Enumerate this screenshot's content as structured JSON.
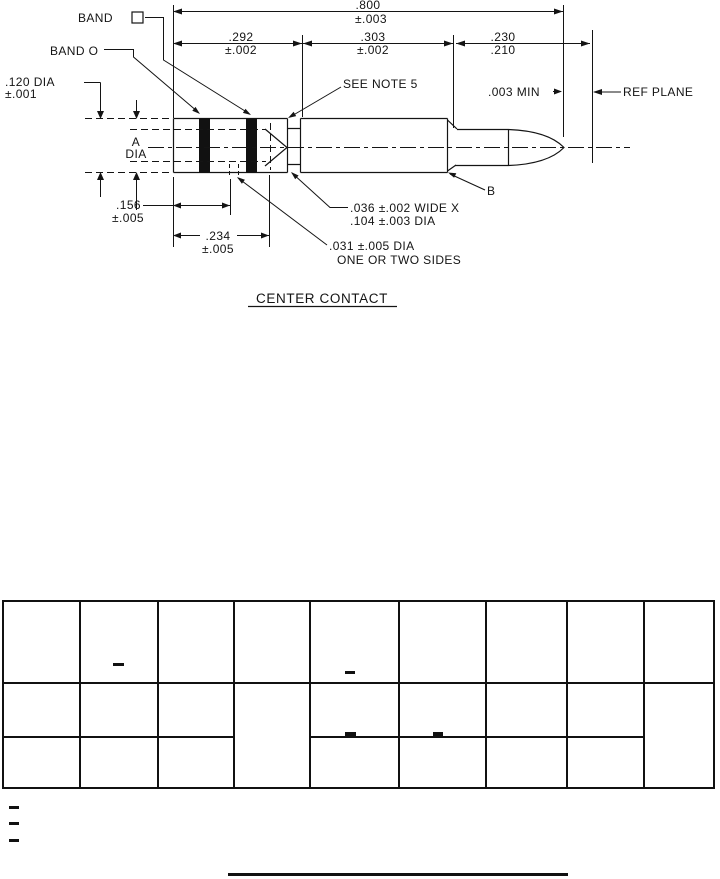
{
  "drawing": {
    "title": "CENTER CONTACT",
    "callouts": {
      "band1_label": "BAND",
      "band1_symbol": "square",
      "band2_label": "BAND O",
      "dia120_value": ".120 DIA",
      "dia120_tol": "±.001",
      "a_dia_line1": "A",
      "a_dia_line2": "DIA",
      "see_note": "SEE NOTE 5",
      "min_gap": ".003 MIN",
      "ref_plane": "REF PLANE",
      "point_b": "B",
      "groove_line1": ".036 ±.002 WIDE  X",
      "groove_line2": ".104 ±.003 DIA",
      "hole_line1": ".031 ±.005 DIA",
      "hole_line2": "ONE OR TWO SIDES"
    },
    "dimensions": {
      "overall": {
        "value": ".800",
        "tol": "±.003"
      },
      "seg1": {
        "value": ".292",
        "tol": "±.002"
      },
      "seg2": {
        "value": ".303",
        "tol": "±.002"
      },
      "seg3": {
        "max": ".230",
        "min": ".210"
      },
      "len156": {
        "value": ".156",
        "tol": "±.005"
      },
      "len234": {
        "value": ".234",
        "tol": "±.005"
      }
    },
    "line_color": "#141414",
    "band_color": "#111111"
  },
  "table": {
    "columns": 9,
    "rows": 3,
    "cells_empty": true,
    "merged_cells": [
      "col4-rows2-3",
      "col9-rows2-3"
    ],
    "dash_marks": [
      "row1-col2",
      "row1-col5",
      "row2-bottom-col5",
      "row2-bottom-col6"
    ]
  },
  "footer": {
    "left_dash_count": 3,
    "has_bottom_rule": true
  }
}
